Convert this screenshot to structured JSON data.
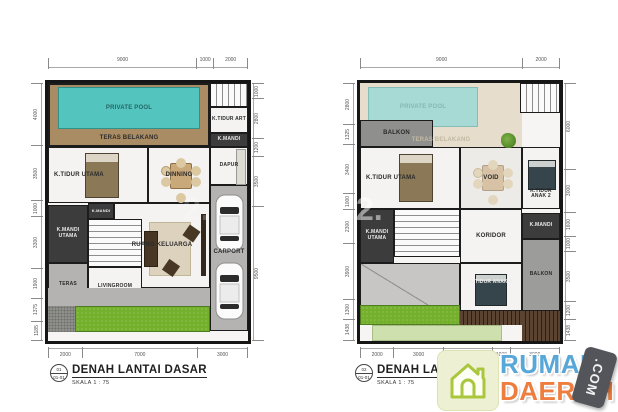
{
  "watermark": {
    "text": "2."
  },
  "colors": {
    "pool": "#54c4be",
    "pool_faded": "#a8dad5",
    "deck_wood": "#a98c63",
    "deck_cream": "#e7ddcc",
    "grass": "#74b02c",
    "dark_room": "#3c3c3c",
    "logo_blue": "#57a7d9",
    "logo_orange": "#ee7e3f",
    "logo_badge_gray": "#54555a",
    "logo_tile_green": "#eef0d3"
  },
  "plans": [
    {
      "marker": {
        "no": "01",
        "sheet": "01-01"
      },
      "title": "DENAH LANTAI DASAR",
      "scale": "SKALA   1 : 75",
      "rooms": {
        "pool": "PRIVATE POOL",
        "teras_belakang": "TERAS BELAKANG",
        "k_tidur_art": "K.TIDUR ART",
        "k_mandi_atas": "K.MANDI",
        "k_tidur_utama": "K.TIDUR UTAMA",
        "dinning": "DINNING",
        "dapur": "DAPUR",
        "carport": "CARPORT",
        "k_mandi": "K.MANDI",
        "k_mandi_utama": "K.MANDI UTAMA",
        "ruang_keluarga": "RUANG KELUARGA",
        "teras": "TERAS",
        "livingroom": "LIVINGROOM"
      },
      "dims": {
        "top": [
          "9000",
          "1000",
          "2000"
        ],
        "bottom": [
          "2000",
          "7000",
          "3000"
        ],
        "left": [
          "4000",
          "3500",
          "1000",
          "3300",
          "1900",
          "1375",
          "1185"
        ],
        "right": [
          "1000",
          "2800",
          "1200",
          "3500",
          "9500"
        ]
      }
    },
    {
      "marker": {
        "no": "02",
        "sheet": "01-01"
      },
      "title": "DENAH LANTAI",
      "scale": "SKALA   1 : 75",
      "rooms": {
        "pool": "PRIVATE POOL",
        "teras_belakang": "TERAS BELAKANG",
        "balkon_kiri": "BALKON",
        "k_tidur_utama": "K.TIDUR UTAMA",
        "void": "VOID",
        "k_tidur_anak2": "K.TIDUR ANAK 2",
        "koridor": "KORIDOR",
        "k_mandi_utama": "K.MANDI UTAMA",
        "k_mandi": "K.MANDI",
        "k_tidur_anak1": "K.TIDUR ANAK 1",
        "balkon_kanan": "BALKON"
      },
      "dims": {
        "top": [
          "9000",
          "2000"
        ],
        "bottom": [
          "2000",
          "3000",
          "3000",
          "1000",
          "3000"
        ],
        "left": [
          "2800",
          "1325",
          "3400",
          "1000",
          "2300",
          "3900",
          "1300",
          "1438"
        ],
        "right": [
          "6000",
          "3000",
          "1600",
          "1000",
          "3500",
          "1200",
          "1438"
        ]
      }
    }
  ],
  "logo": {
    "word1": "RUMAH",
    "word2": "DAERAH",
    "badge": ".COM"
  }
}
